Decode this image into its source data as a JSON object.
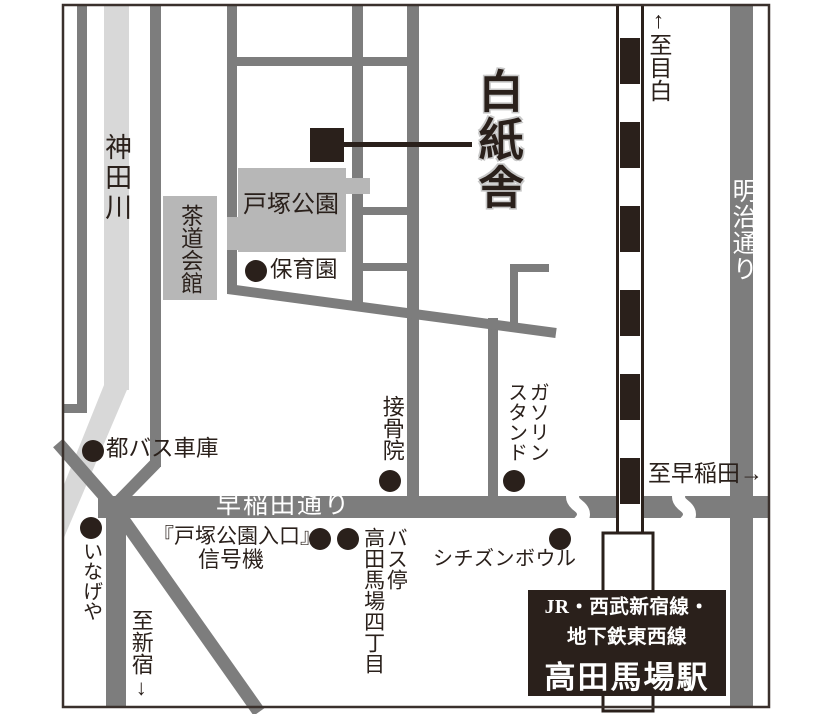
{
  "map": {
    "title": "白紙舎",
    "river": "神田川",
    "roads": {
      "waseda": "早稲田通り",
      "meiji": "明治通り"
    },
    "directions": {
      "mejiro": "↑至目白",
      "waseda": "至早稲田→",
      "shinjuku": "至新宿↓"
    },
    "places": {
      "park": "戸塚公園",
      "tea_hall": "茶道会館",
      "nursery": "保育園",
      "bus_depot": "都バス車庫",
      "inageya": "いなげや",
      "clinic": "接骨院",
      "gas1": "ガソリン",
      "gas2": "スタンド",
      "signal1": "『戸塚公園入口』",
      "signal2": "信号機",
      "busstop1": "バス停",
      "busstop2": "高田馬場四丁目",
      "bowl": "シチズンボウル"
    },
    "station": {
      "line1": "JR・西武新宿線・",
      "line2": "地下鉄東西線",
      "name": "高田馬場駅"
    },
    "colors": {
      "ink": "#2a201b",
      "road": "#7d7d7d",
      "river": "#d8d8d8",
      "park": "#b7b7b7"
    }
  }
}
